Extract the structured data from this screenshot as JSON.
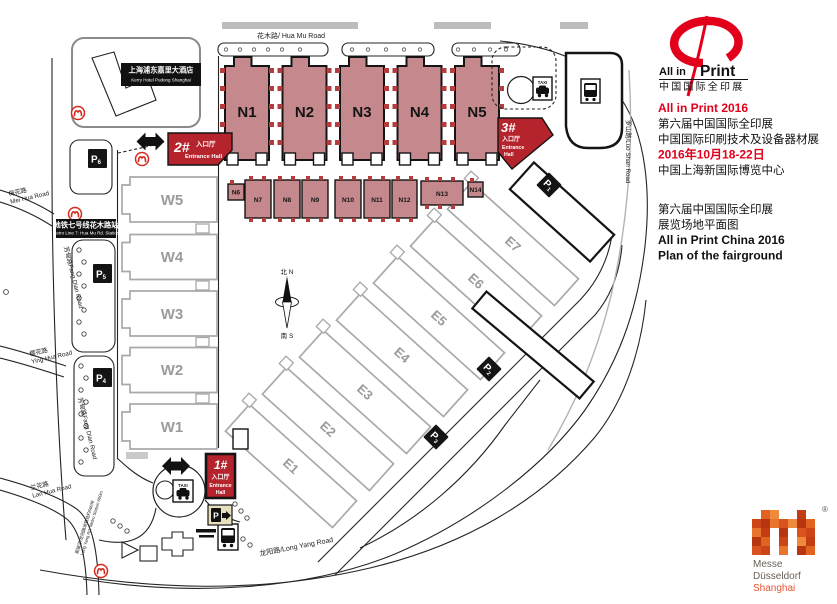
{
  "colors": {
    "hallFill": "#c5898d",
    "hallStroke": "#141414",
    "entranceRed": "#b5242c",
    "accentRed": "#e2001a",
    "grayHall": "#a9a9a9",
    "metroRed": "#d42b1e",
    "messeOrange": "#d9531e",
    "parkingSignTan": "#e7e0bd"
  },
  "rightPanel": {
    "logo": {
      "en1": "All in",
      "en2": "Print",
      "cn": "中国国际全印展"
    },
    "info": {
      "l1": "All in Print 2016",
      "l2": "第六届中国国际全印展",
      "l3": "中国国际印刷技术及设备器材展",
      "l4": "2016年10月18-22日",
      "l5": "中国上海新国际博览中心"
    },
    "plan": {
      "l1": "第六届中国国际全印展",
      "l2": "展览场地平面图",
      "l3": "All in Print China 2016",
      "l4": "Plan of the fairground"
    },
    "messe": {
      "l1": "Messe",
      "l2": "Düsseldorf",
      "l3": "Shanghai",
      "reg": "®"
    }
  },
  "map": {
    "halls": {
      "n": [
        "N1",
        "N2",
        "N3",
        "N4",
        "N5"
      ],
      "nSmall": [
        "N6",
        "N7",
        "N8",
        "N9",
        "N10",
        "N11",
        "N12",
        "N13",
        "N14"
      ],
      "w": [
        "W5",
        "W4",
        "W3",
        "W2",
        "W1"
      ],
      "e": [
        "E1",
        "E2",
        "E3",
        "E4",
        "E5",
        "E6",
        "E7"
      ]
    },
    "entrances": {
      "no1": {
        "no": "1#",
        "cn": "入口厅",
        "en1": "Entrance",
        "en2": "Hall"
      },
      "no2": {
        "no": "2#",
        "cn": "入口厅",
        "en": "Entrance Hall"
      },
      "no3": {
        "no": "3#",
        "cn": "入口厅",
        "en1": "Entrance",
        "en2": "Hall"
      }
    },
    "parking": {
      "p1": {
        "p": "P",
        "n": "1"
      },
      "p2": {
        "p": "P",
        "n": "2"
      },
      "p3": {
        "p": "P",
        "n": "3"
      },
      "p4": {
        "p": "P",
        "n": "4"
      },
      "p5": {
        "p": "P",
        "n": "5"
      },
      "p6": {
        "p": "P",
        "n": "6"
      }
    },
    "roads": {
      "huaMu": "花木路/ Hua Mu Road",
      "luoShan": "罗山路/Luo Shan Road",
      "longYang": "龙阳路/Long Yang Road",
      "meiHuaCn": "梅花路",
      "meiHuaEn": "Mei Hua Road",
      "fangDian": "芳甸路Fang Dian Road",
      "yingHuaCn": "樱花路",
      "yingHuaEn": "Ying Hua Road",
      "lanHuaCn": "兰花路",
      "lanHuaEn": "Lan Hua Road"
    },
    "hotel": {
      "cn": "上海浦东嘉里大酒店",
      "en": "Kerry Hotel Pudong Shanghai"
    },
    "metroStation": {
      "cn": "地铁七号线花木路站",
      "en": "Metro Line 7: Hua Mu Rd. Station"
    },
    "transitNote": {
      "cn": "距磁浮/龙阳路地铁站约600米",
      "en": "Long Yang Rd. Metro Station 600m"
    },
    "compass": {
      "north": "北 N",
      "south": "南 S"
    },
    "taxi": "TAXI"
  }
}
